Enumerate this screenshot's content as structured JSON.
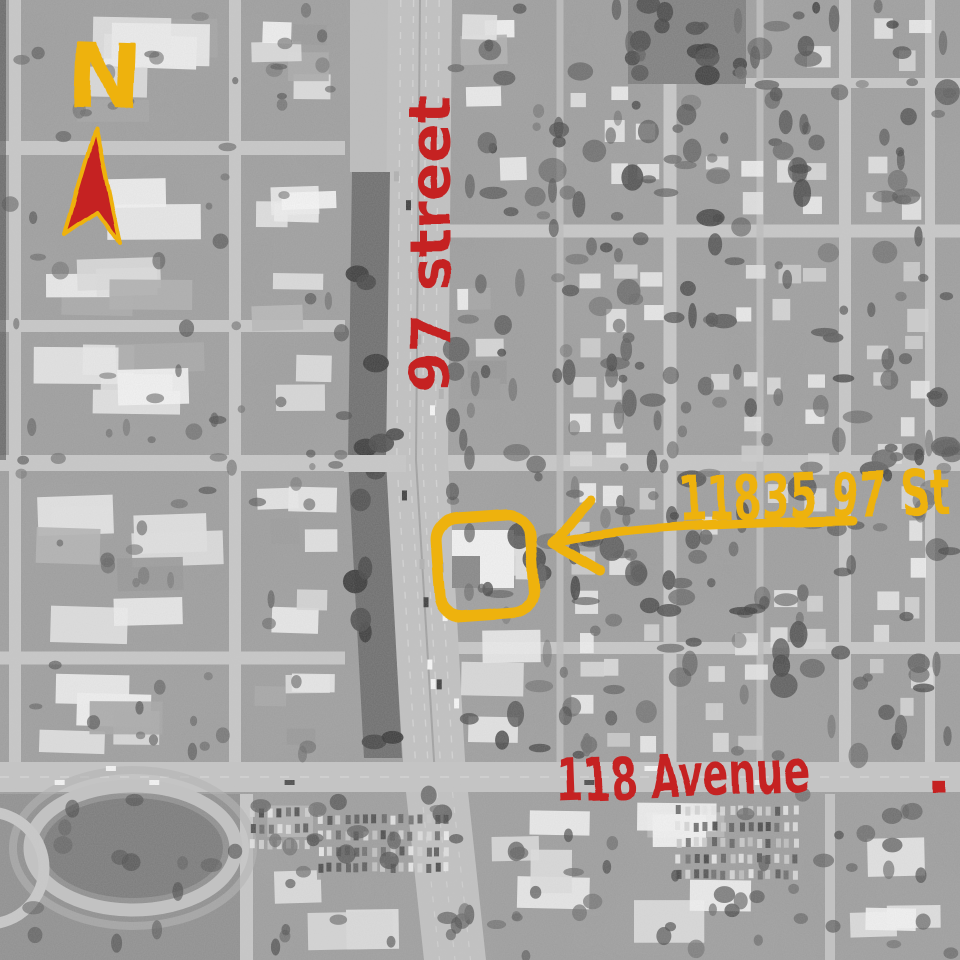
{
  "map": {
    "colors": {
      "annotation_red": "#c52323",
      "annotation_yellow": "#eeb211"
    }
  },
  "annotations": {
    "north_label": "N",
    "street_label": "97 street",
    "address_label": "11835 97 St",
    "avenue_label": "118 Avenue",
    "period_dot": "."
  }
}
